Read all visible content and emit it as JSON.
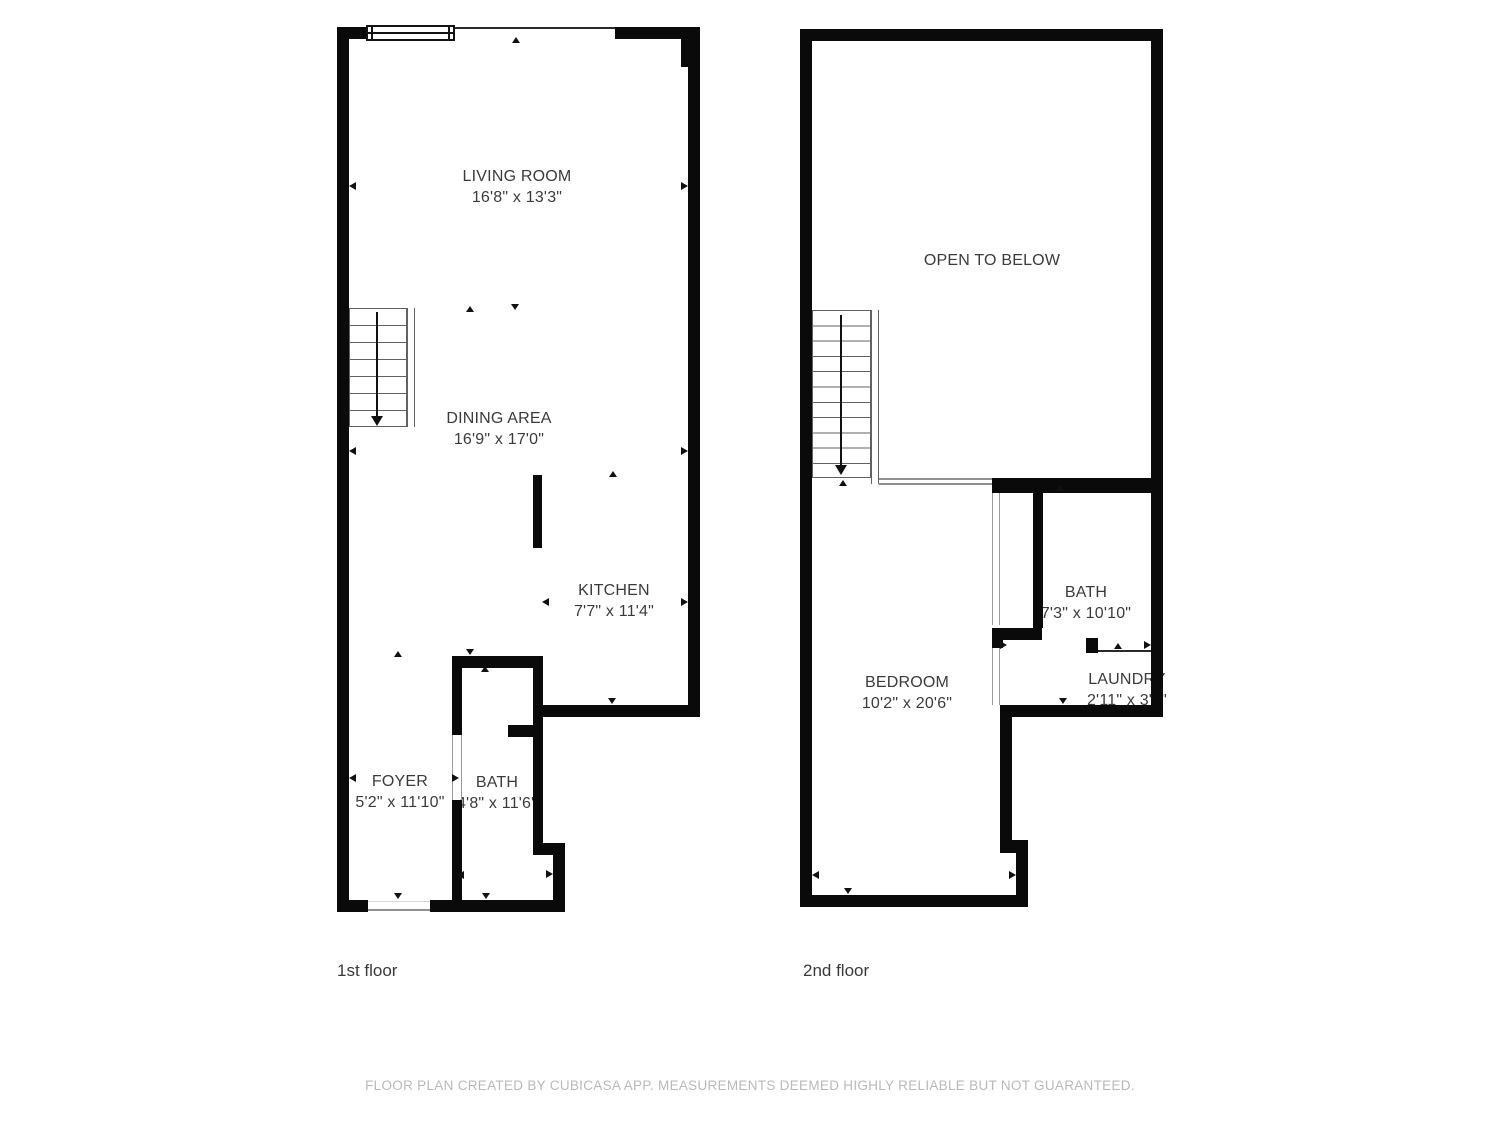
{
  "floors": [
    {
      "label": "1st floor",
      "rooms": [
        {
          "name": "LIVING ROOM",
          "dimensions": "16'8\" x 13'3\""
        },
        {
          "name": "DINING AREA",
          "dimensions": "16'9\" x 17'0\""
        },
        {
          "name": "KITCHEN",
          "dimensions": "7'7\" x 11'4\""
        },
        {
          "name": "FOYER",
          "dimensions": "5'2\" x 11'10\""
        },
        {
          "name": "BATH",
          "dimensions": "4'8\" x 11'6\""
        }
      ]
    },
    {
      "label": "2nd floor",
      "rooms": [
        {
          "name": "OPEN TO BELOW",
          "dimensions": ""
        },
        {
          "name": "BATH",
          "dimensions": "7'3\" x 10'10\""
        },
        {
          "name": "BEDROOM",
          "dimensions": "10'2\" x 20'6\""
        },
        {
          "name": "LAUNDRY",
          "dimensions": "2'11\" x 3'0\""
        }
      ]
    }
  ],
  "footer": {
    "disclaimer": "FLOOR PLAN CREATED BY CUBICASA APP. MEASUREMENTS DEEMED HIGHLY RELIABLE BUT NOT GUARANTEED."
  },
  "colors": {
    "wall": "#0a0a0a",
    "room_label": "#3b3b3b",
    "floor_label": "#3a3a3a",
    "disclaimer_text": "#b9b9b9",
    "background": "#ffffff"
  }
}
